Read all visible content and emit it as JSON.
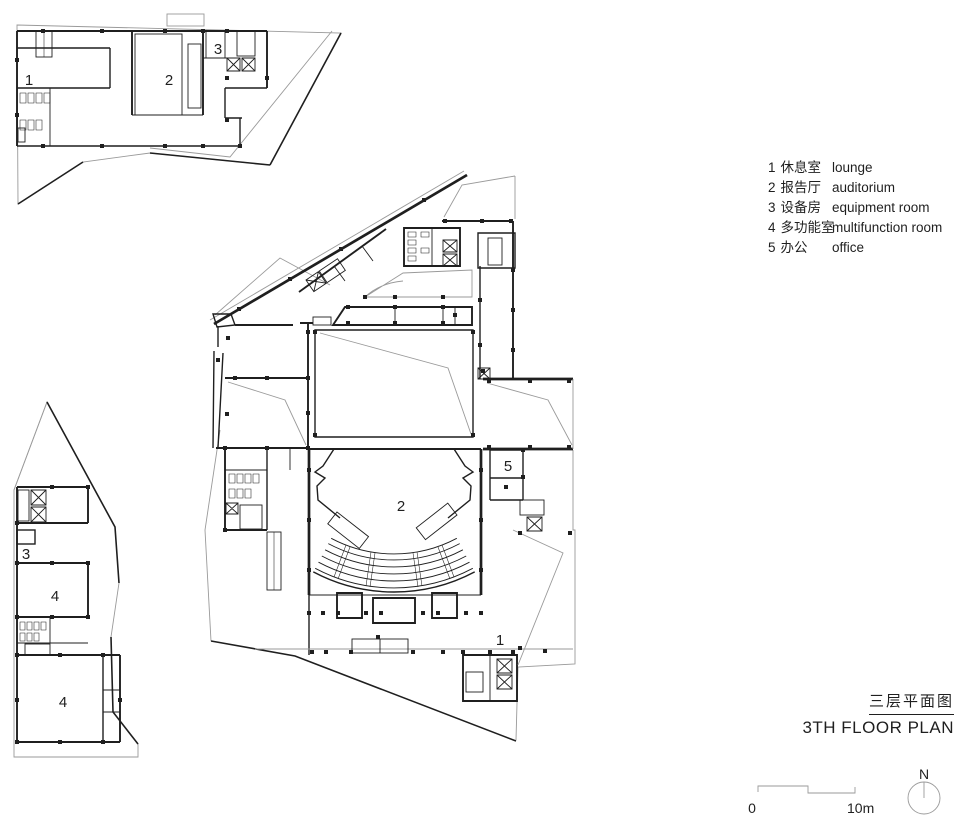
{
  "legend": {
    "items": [
      {
        "num": "1",
        "zh": "休息室",
        "en": "lounge"
      },
      {
        "num": "2",
        "zh": "报告厅",
        "en": "auditorium"
      },
      {
        "num": "3",
        "zh": "设备房",
        "en": "equipment room"
      },
      {
        "num": "4",
        "zh": "多功能室",
        "en": "multifunction room"
      },
      {
        "num": "5",
        "zh": "办公",
        "en": "office"
      }
    ]
  },
  "title": {
    "zh": "三层平面图",
    "en": "3TH FLOOR PLAN"
  },
  "scale_bar": {
    "start": "0",
    "end": "10m"
  },
  "north_arrow": {
    "label": "N"
  },
  "room_labels": {
    "main_plan": {
      "auditorium": "2",
      "office": "5",
      "lounge": "1"
    },
    "upper_fragment": {
      "lounge": "1",
      "auditorium": "2",
      "equipment": "3"
    },
    "lower_fragment": {
      "equipment": "3",
      "multifunction_upper": "4",
      "multifunction_lower": "4"
    }
  },
  "colors": {
    "ink": "#1f1f1f",
    "site_line": "#9a9a9a",
    "background": "#ffffff"
  }
}
